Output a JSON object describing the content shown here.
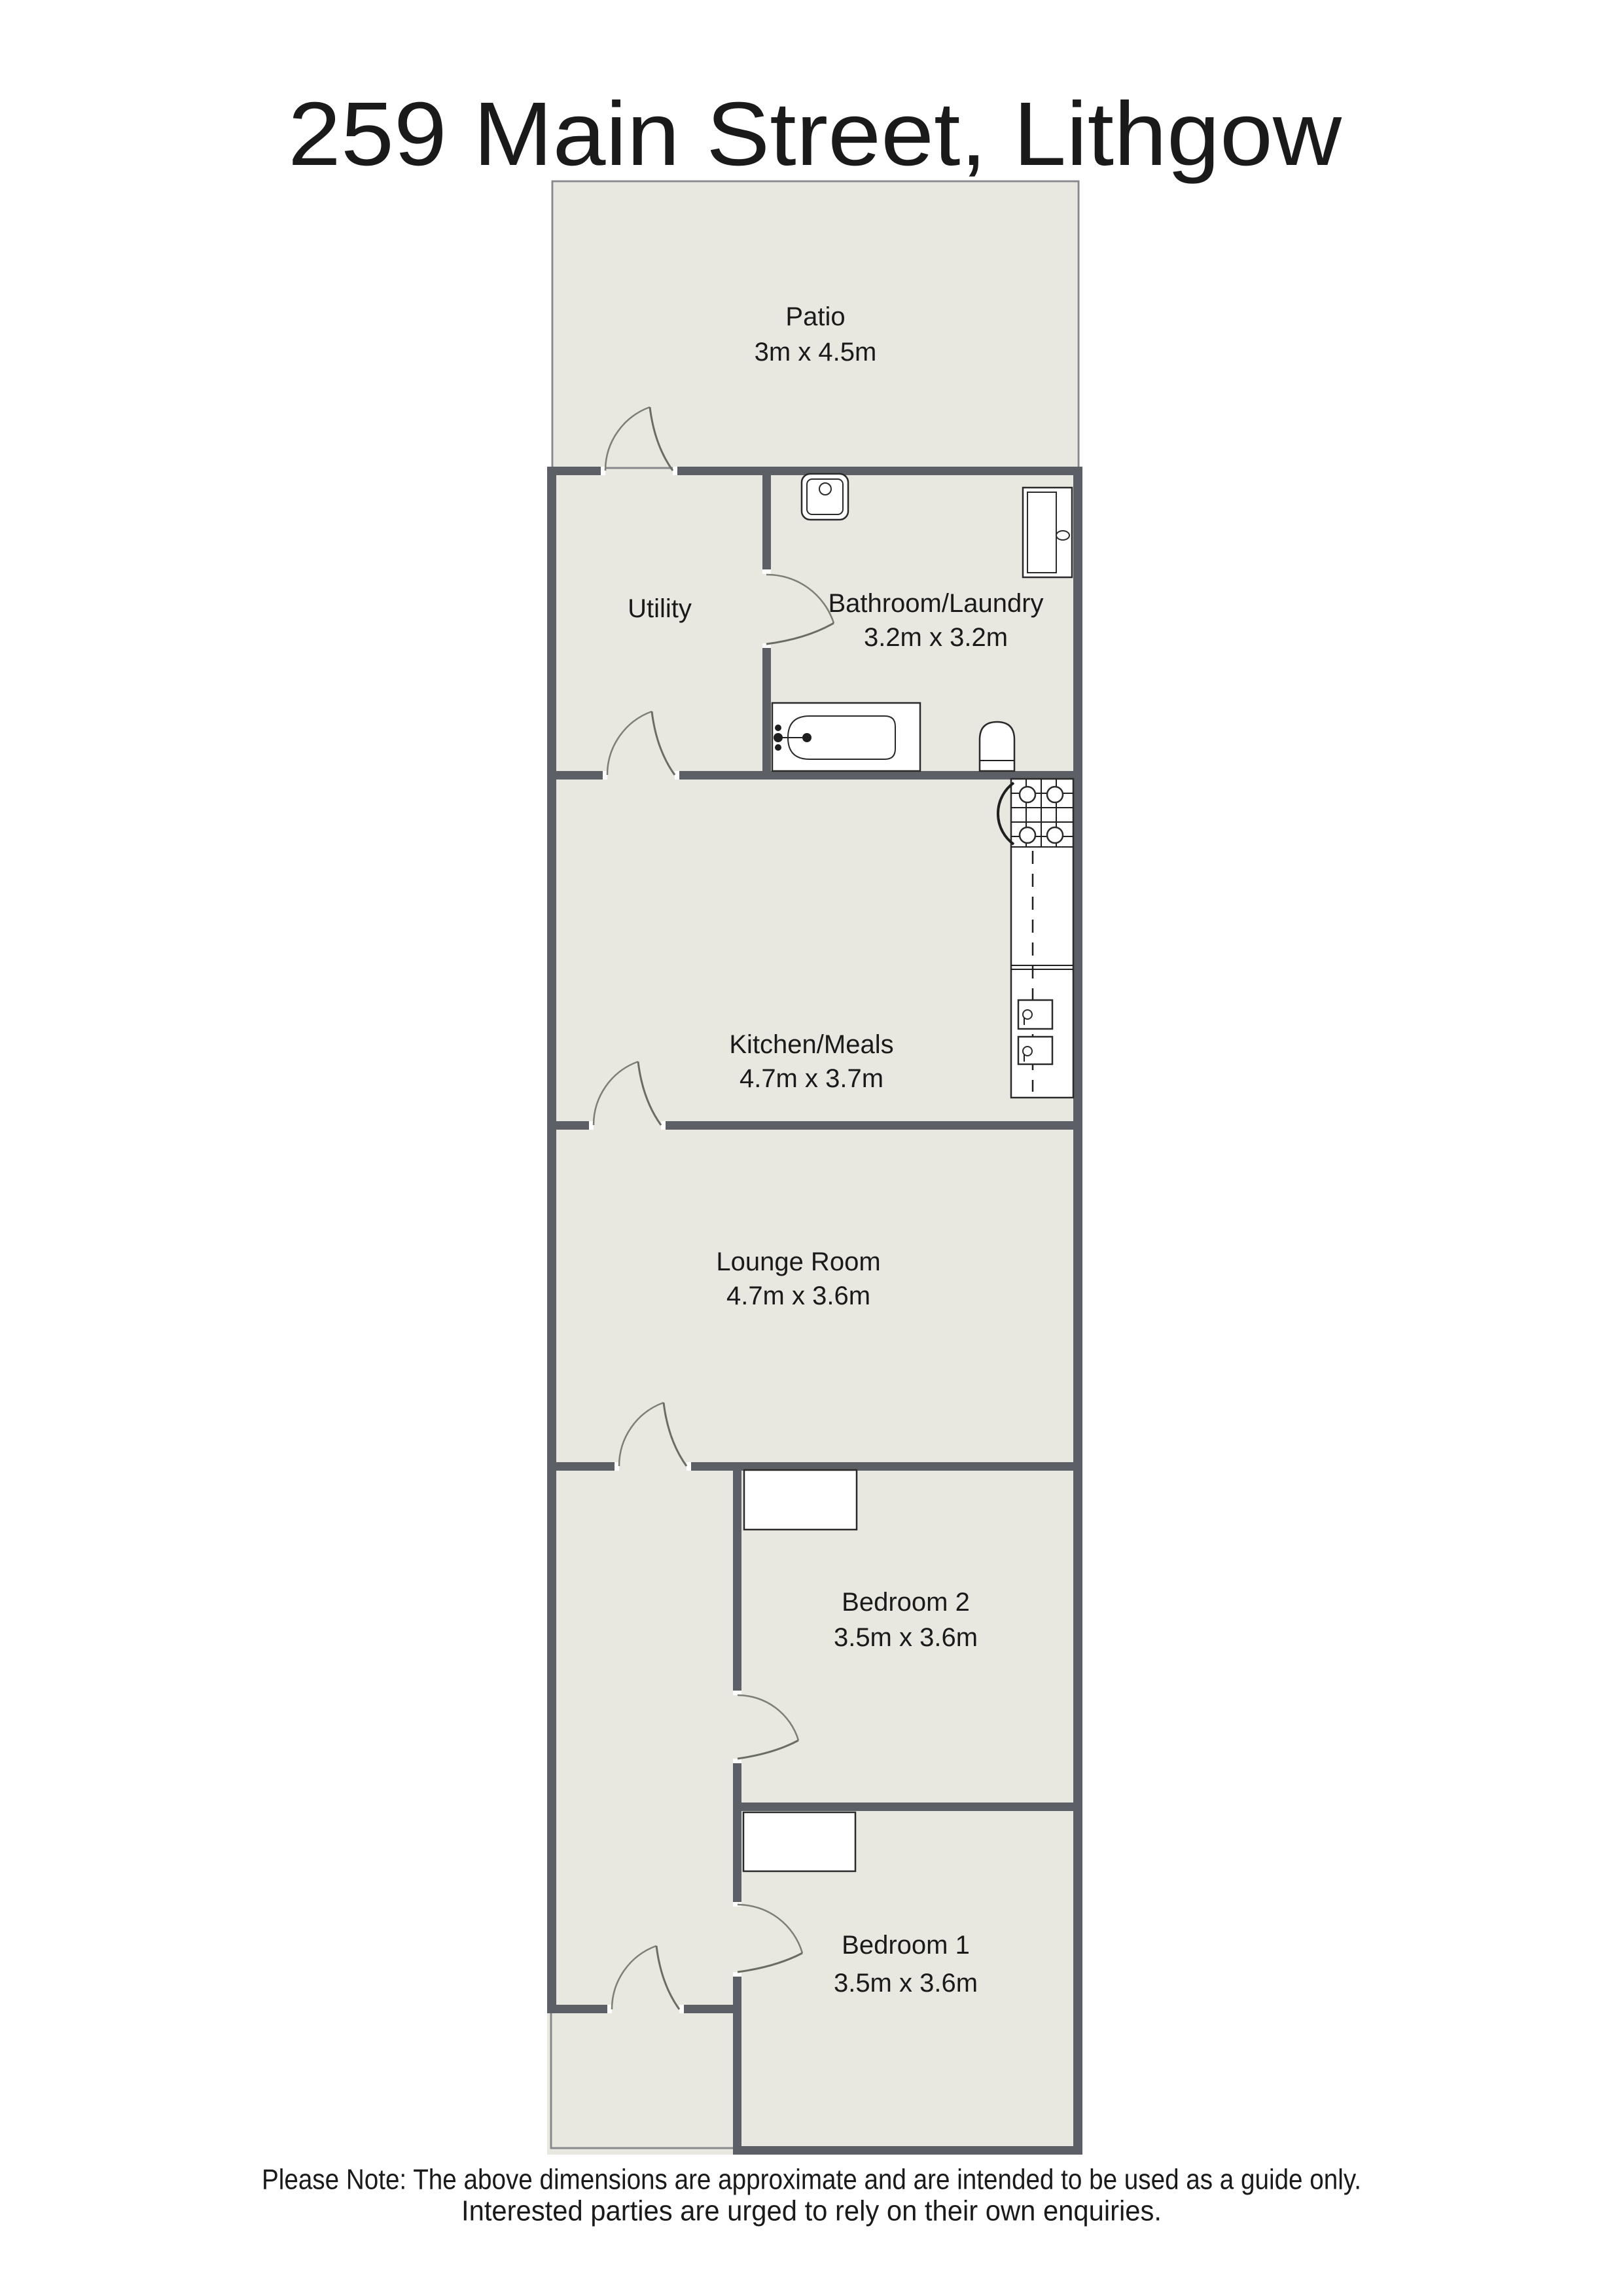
{
  "title": "259 Main Street, Lithgow",
  "rooms": {
    "patio": {
      "label": "Patio",
      "dims": "3m x 4.5m"
    },
    "utility": {
      "label": "Utility",
      "dims": ""
    },
    "bathroom": {
      "label": "Bathroom/Laundry",
      "dims": "3.2m x 3.2m"
    },
    "kitchen": {
      "label": "Kitchen/Meals",
      "dims": "4.7m x 3.7m"
    },
    "lounge": {
      "label": "Lounge Room",
      "dims": "4.7m x 3.6m"
    },
    "bedroom2": {
      "label": "Bedroom 2",
      "dims": "3.5m x 3.6m"
    },
    "bedroom1": {
      "label": "Bedroom 1",
      "dims": "3.5m x 3.6m"
    }
  },
  "fixtures": [
    "laundry-sink",
    "bathtub",
    "toilet",
    "sliding-door-panel",
    "stove-cooktop",
    "kitchen-counter",
    "double-sink",
    "wardrobe-bedroom2",
    "wardrobe-bedroom1"
  ],
  "note": {
    "line1": "Please Note: The above dimensions are approximate and are intended to be used as a guide only.",
    "line2": "Interested parties are urged to rely on their own enquiries."
  },
  "colors": {
    "wall": "#5c6066",
    "floor": "#e8e8e0",
    "outline": "#87898c",
    "fixture_stroke": "#2a2a2a",
    "door_swing": "#7c7f74",
    "text": "#1a1a1a",
    "background": "#ffffff"
  }
}
